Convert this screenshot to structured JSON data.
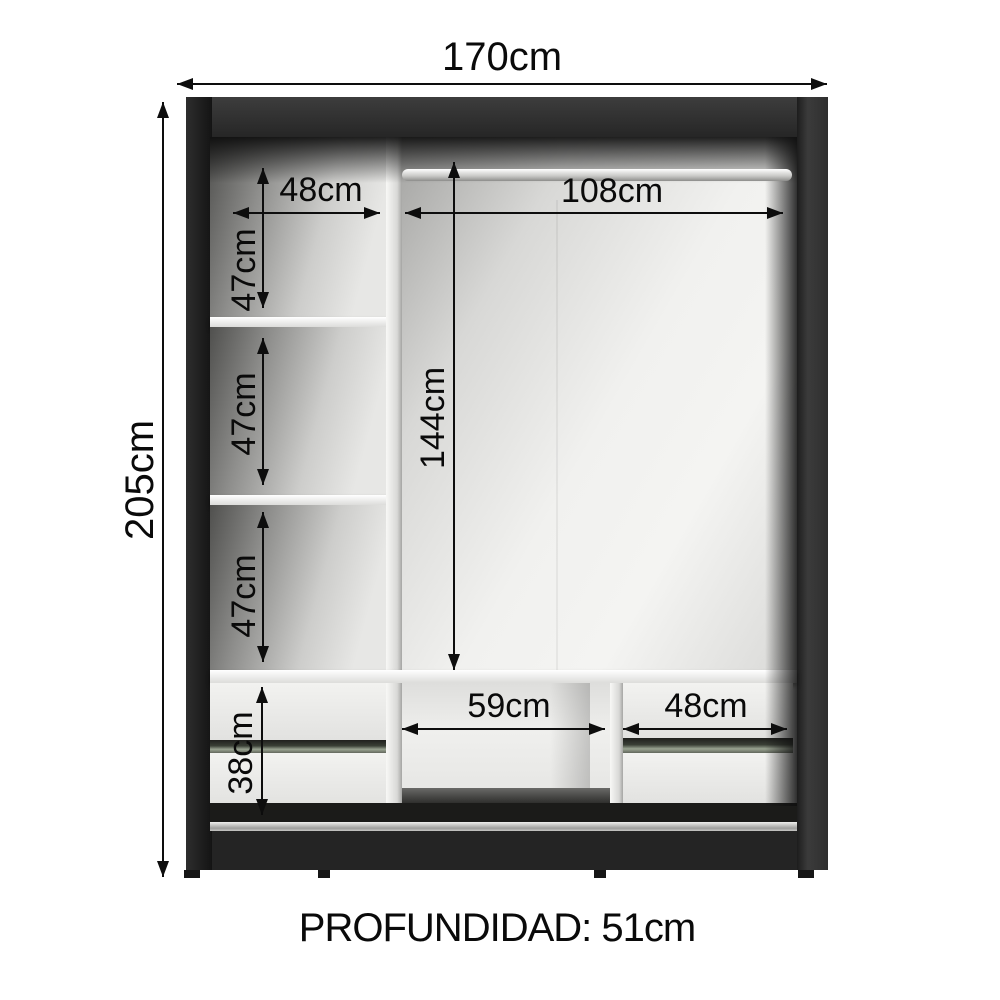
{
  "diagram": {
    "product": "wardrobe-internal-dimensions",
    "overall": {
      "width": "170cm",
      "height": "205cm"
    },
    "top_section": {
      "left_shelf_width": "48cm",
      "hanging_rod_width": "108cm"
    },
    "left_column": {
      "compartment_1_height": "47cm",
      "compartment_2_height": "47cm",
      "compartment_3_height": "47cm"
    },
    "main_compartment": {
      "height": "144cm"
    },
    "bottom_section": {
      "middle_opening_width": "59cm",
      "right_drawers_width": "48cm",
      "drawers_height": "38cm"
    },
    "footer": {
      "depth": "PROFUNDIDAD: 51cm"
    },
    "colors": {
      "background": "#ffffff",
      "frame": "#242424",
      "interior": "#eaeae8",
      "panels": "#f2f2f0",
      "rod": "#d6d6d4",
      "dimension_lines": "#0d0d0d"
    }
  }
}
